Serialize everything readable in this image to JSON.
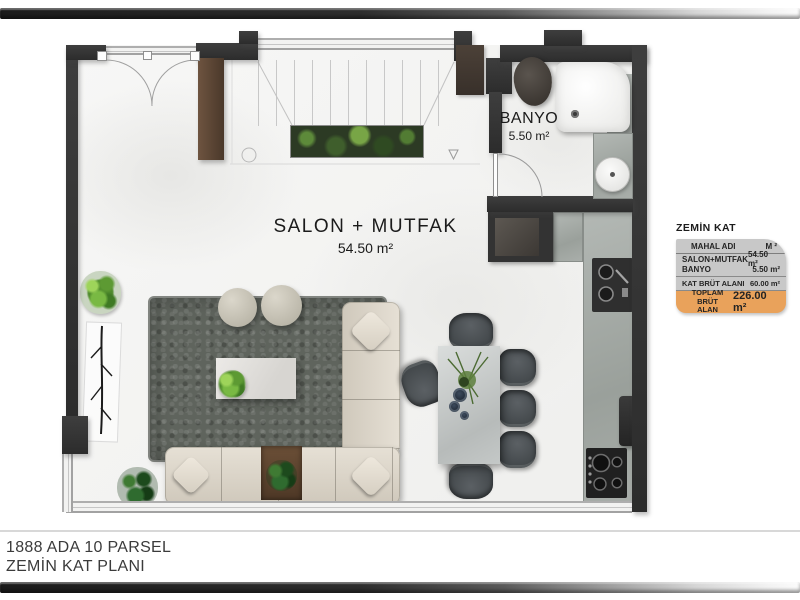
{
  "plan": {
    "salon": {
      "name": "SALON + MUTFAK",
      "area": "54.50 m²"
    },
    "banyo": {
      "name": "BANYO",
      "area": "5.50 m²"
    }
  },
  "info_table": {
    "title": "ZEMİN KAT",
    "columns": {
      "name": "MAHAL ADI",
      "unit": "M ²"
    },
    "rows": [
      {
        "label": "SALON+MUTFAK",
        "value": "54.50 m²"
      },
      {
        "label": "BANYO",
        "value": "5.50 m²"
      }
    ],
    "subtotal": {
      "label": "KAT BRÜT ALANI",
      "value": "60.00 m²"
    },
    "total": {
      "label1": "TOPLAM BRÜT",
      "label2": "ALAN",
      "value": "226.00 m²"
    }
  },
  "footer": {
    "line1": "1888 ADA 10 PARSEL",
    "line2": "ZEMİN KAT PLANI"
  },
  "colors": {
    "wall": "#343434",
    "accent_orange": "#e9a25b",
    "table_gray": "#c8c8c8"
  }
}
